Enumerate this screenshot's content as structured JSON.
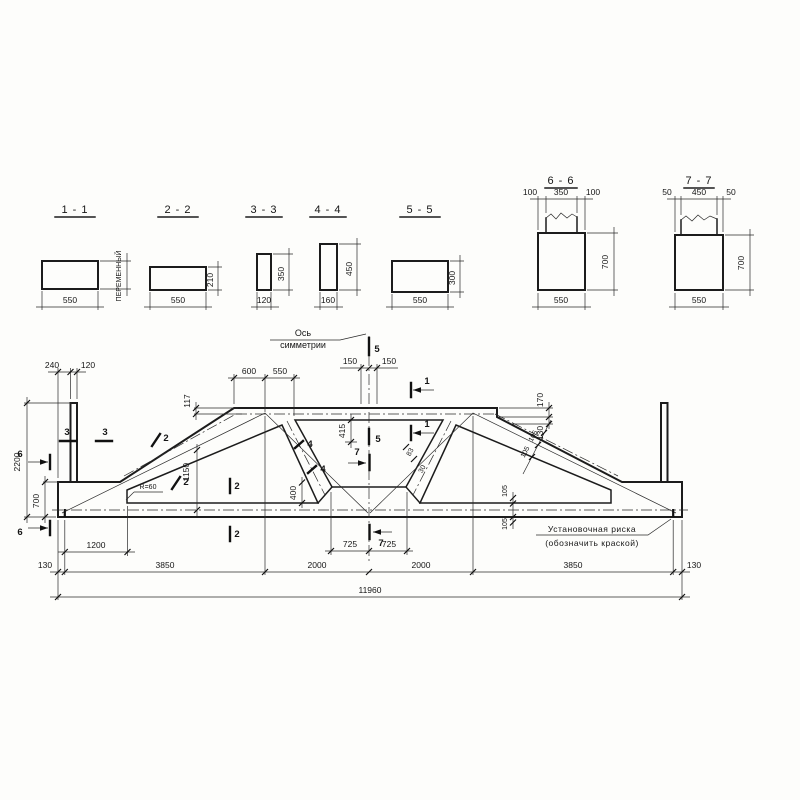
{
  "sections": {
    "s11": {
      "title": "1 - 1",
      "w": "550",
      "h": "ПЕРЕМЕННЫЙ"
    },
    "s22": {
      "title": "2 - 2",
      "w": "550",
      "h": "210"
    },
    "s33": {
      "title": "3 - 3",
      "w": "120",
      "h": "350"
    },
    "s44": {
      "title": "4 - 4",
      "w": "160",
      "h": "450"
    },
    "s55": {
      "title": "5 - 5",
      "w": "550",
      "h": "300"
    },
    "s66": {
      "title": "6 - 6",
      "tl": "100",
      "tm": "350",
      "tr": "100",
      "h": "700",
      "w": "550"
    },
    "s77": {
      "title": "7 - 7",
      "tl": "50",
      "tm": "450",
      "tr": "50",
      "h": "700",
      "w": "550"
    }
  },
  "elevation": {
    "axis": [
      "Ось",
      "симметрии"
    ],
    "note": [
      "Установочная риска",
      "(обозначить краской)"
    ],
    "radius": "R=60",
    "dims": {
      "d240": "240",
      "d120": "120",
      "d600": "600",
      "d550": "550",
      "d150l": "150",
      "d150r": "150",
      "d117": "117",
      "d170": "170",
      "d130step": "130",
      "d415": "415",
      "d400": "400",
      "d1150": "1150",
      "d83": "83",
      "d30": "30",
      "d105a": "105",
      "d105b": "105",
      "d105c": "105",
      "d105d": "105",
      "d2200": "2200",
      "d700": "700",
      "d1200": "1200",
      "d725l": "725",
      "d725r": "725",
      "chain": [
        "130",
        "3850",
        "2000",
        "2000",
        "3850",
        "130"
      ],
      "total": "11960"
    },
    "marks": {
      "m1": "1",
      "m2": "2",
      "m3": "3",
      "m4": "4",
      "m5": "5",
      "m6": "6",
      "m7": "7"
    }
  }
}
